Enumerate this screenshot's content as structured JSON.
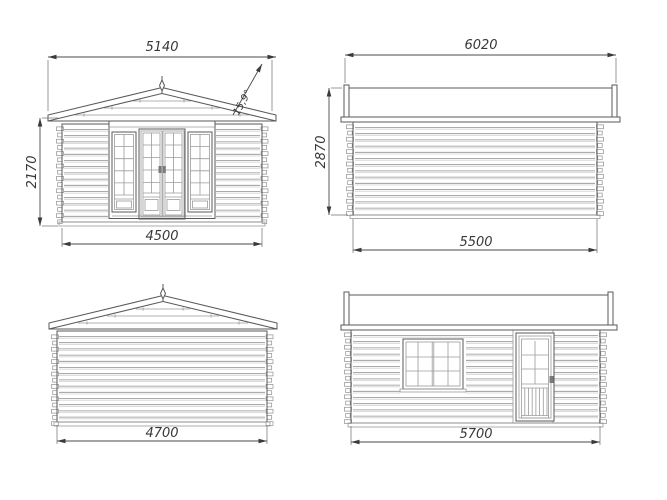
{
  "drawing": {
    "background_color": "#ffffff",
    "outline_color": "#4a4a4a",
    "siding_line_color": "#8f8f8f",
    "dimension_color": "#383838",
    "views": {
      "front_elevation": {
        "overall_width": "5140",
        "wall_height": "2170",
        "base_width": "4500",
        "roof_angle": "15,9°"
      },
      "side_elevation_upper": {
        "overall_width": "6020",
        "overall_height": "2870",
        "base_width": "5500"
      },
      "rear_elevation": {
        "base_width": "4700"
      },
      "side_elevation_lower": {
        "base_width": "5700"
      }
    }
  }
}
